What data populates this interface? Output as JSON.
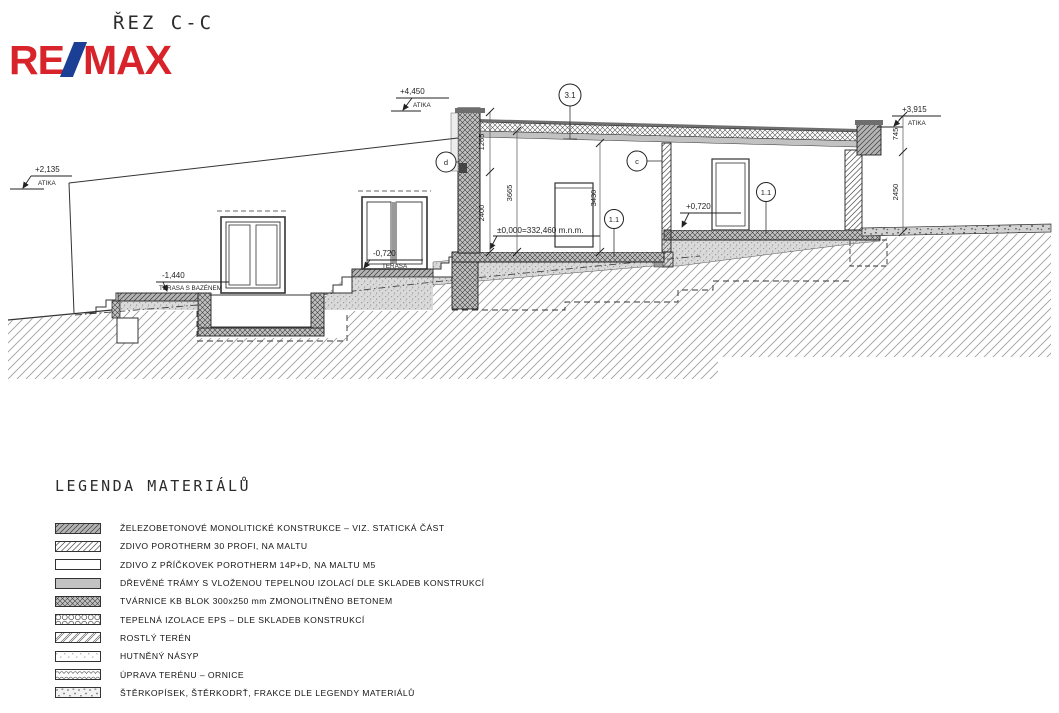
{
  "page": {
    "title": "ŘEZ C-C"
  },
  "logo": {
    "part1": "RE",
    "part2": "MAX",
    "red": "#d8232a",
    "blue": "#1b3f94"
  },
  "drawing": {
    "levels": {
      "atika_left": {
        "value": "+2,135",
        "label": "ATIKA"
      },
      "atika_main": {
        "value": "+4,450",
        "label": "ATIKA"
      },
      "atika_right": {
        "value": "+3,915",
        "label": "ATIKA"
      },
      "terrace_pool": {
        "value": "-1,440",
        "label": "TERASA S BAZÉNEM"
      },
      "terrace": {
        "value": "-0,720",
        "label": "TERASA"
      },
      "floor_right": {
        "value": "+0,720"
      },
      "zero": {
        "value": "±0,000=332,460 m.n.m."
      }
    },
    "dims": {
      "parapet": "1265",
      "glazing": "2400",
      "room_left": "3665",
      "door": "3430",
      "attic_right": "745",
      "wall_right": "2450"
    },
    "callouts": {
      "roof": "3.1",
      "wall_d": "d",
      "wall_c": "c",
      "floor_left": "1.1",
      "floor_right": "1.1"
    }
  },
  "legend": {
    "title": "LEGENDA MATERIÁLŮ",
    "items": [
      {
        "swatch": "reinforced-concrete-hatch",
        "label": "ŽELEZOBETONOVÉ MONOLITICKÉ KONSTRUKCE – VIZ. STATICKÁ ČÁST"
      },
      {
        "swatch": "porotherm-hatch",
        "label": "ZDIVO POROTHERM 30 PROFI, NA MALTU"
      },
      {
        "swatch": "partition-white",
        "label": "ZDIVO Z PŘÍČKOVEK POROTHERM 14P+D, NA MALTU M5"
      },
      {
        "swatch": "timber-gray",
        "label": "DŘEVĚNÉ TRÁMY S VLOŽENOU TEPELNOU IZOLACÍ DLE SKLADEB KONSTRUKCÍ"
      },
      {
        "swatch": "kb-block-crosshatch",
        "label": "TVÁRNICE KB BLOK 300x250 mm ZMONOLITNĚNO BETONEM"
      },
      {
        "swatch": "eps-insulation",
        "label": "TEPELNÁ IZOLACE EPS – DLE SKLADEB KONSTRUKCÍ"
      },
      {
        "swatch": "native-soil",
        "label": "ROSTLÝ TERÉN"
      },
      {
        "swatch": "compacted-fill",
        "label": "HUTNĚNÝ NÁSYP"
      },
      {
        "swatch": "topsoil",
        "label": "ÚPRAVA TERÉNU – ORNICE"
      },
      {
        "swatch": "gravel",
        "label": "ŠTĚRKOPÍSEK, ŠTĚRKODRŤ, FRAKCE DLE LEGENDY MATERIÁLŮ"
      }
    ]
  }
}
